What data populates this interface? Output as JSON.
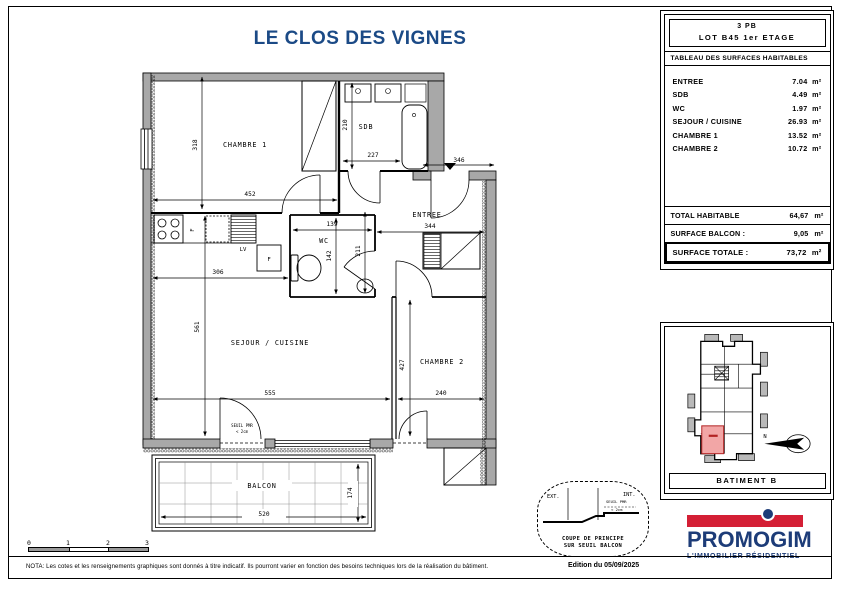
{
  "title": "LE CLOS DES VIGNES",
  "surface_table": {
    "type_label": "3 PB",
    "lot_label": "LOT B45 1er ETAGE",
    "header": "TABLEAU DES SURFACES HABITABLES",
    "rows": [
      {
        "label": "ENTREE",
        "value": "7.04",
        "unit": "m²"
      },
      {
        "label": "SDB",
        "value": "4.49",
        "unit": "m²"
      },
      {
        "label": "WC",
        "value": "1.97",
        "unit": "m²"
      },
      {
        "label": "SEJOUR / CUISINE",
        "value": "26.93",
        "unit": "m²"
      },
      {
        "label": "CHAMBRE 1",
        "value": "13.52",
        "unit": "m²"
      },
      {
        "label": "CHAMBRE 2",
        "value": "10.72",
        "unit": "m²"
      }
    ],
    "totals": [
      {
        "label": "TOTAL HABITABLE",
        "value": "64,67",
        "unit": "m²"
      },
      {
        "label": "SURFACE BALCON :",
        "value": "9,05",
        "unit": "m²"
      },
      {
        "label": "SURFACE TOTALE :",
        "value": "73,72",
        "unit": "m²"
      }
    ]
  },
  "plan": {
    "rooms": {
      "c1": "CHAMBRE 1",
      "sdb": "SDB",
      "wc": "WC",
      "entree": "ENTREE",
      "sejour": "SEJOUR / CUISINE",
      "c2": "CHAMBRE 2",
      "balcon": "BALCON"
    },
    "dims": {
      "c1_h": "318",
      "c1_w": "452",
      "sdb_h": "210",
      "sdb_w": "227",
      "porte_entree": "346",
      "entree_w": "344",
      "entree_h": "211",
      "wc_w": "139",
      "wc_h": "142",
      "cuisine_w": "306",
      "sejour_h": "561",
      "sejour_w": "555",
      "c2_h": "427",
      "c2_w": "240",
      "balcon_w": "520",
      "balcon_h": "174"
    },
    "appliances": {
      "fridge": "F",
      "oven": "F",
      "dishwasher": "LV"
    },
    "door_note_1": "SEUIL PMR",
    "door_note_2": "< 2cm"
  },
  "coupe": {
    "ext": "EXT.",
    "int": "INT.",
    "note_1": "SEUIL PMR",
    "note_2": "< 2cm",
    "caption_1": "COUPE DE PRINCIPE",
    "caption_2": "SUR SEUIL BALCON"
  },
  "site_plan": {
    "caption": "BATIMENT B",
    "north": "N",
    "highlight_color": "#f2a6a6"
  },
  "scale_bar": {
    "t0": "0",
    "t1": "1",
    "t2": "2",
    "t3": "3"
  },
  "logo": {
    "brand": "PROMOGIM",
    "tagline": "L'IMMOBILIER RÉSIDENTIEL",
    "red": "#d41f35",
    "blue": "#1d3c78"
  },
  "footer": {
    "nota": "NOTA: Les cotes et les renseignements graphiques sont donnés à titre indicatif. Ils pourront varier en fonction des besoins techniques lors de la réalisation du bâtiment.",
    "edition": "Edition du 05/09/2025"
  }
}
